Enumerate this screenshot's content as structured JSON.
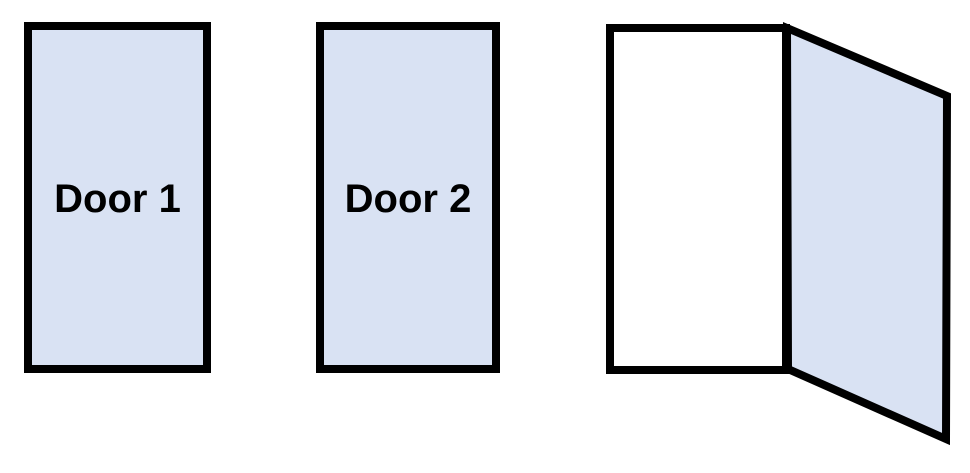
{
  "diagram": {
    "background": "#ffffff",
    "colors": {
      "door_fill": "#d9e2f3",
      "outline": "#000000",
      "open_frame_fill": "#ffffff",
      "label_color": "#000000"
    },
    "doors": [
      {
        "label": "Door 1",
        "state": "closed"
      },
      {
        "label": "Door 2",
        "state": "closed"
      },
      {
        "label": "",
        "state": "open"
      }
    ]
  }
}
